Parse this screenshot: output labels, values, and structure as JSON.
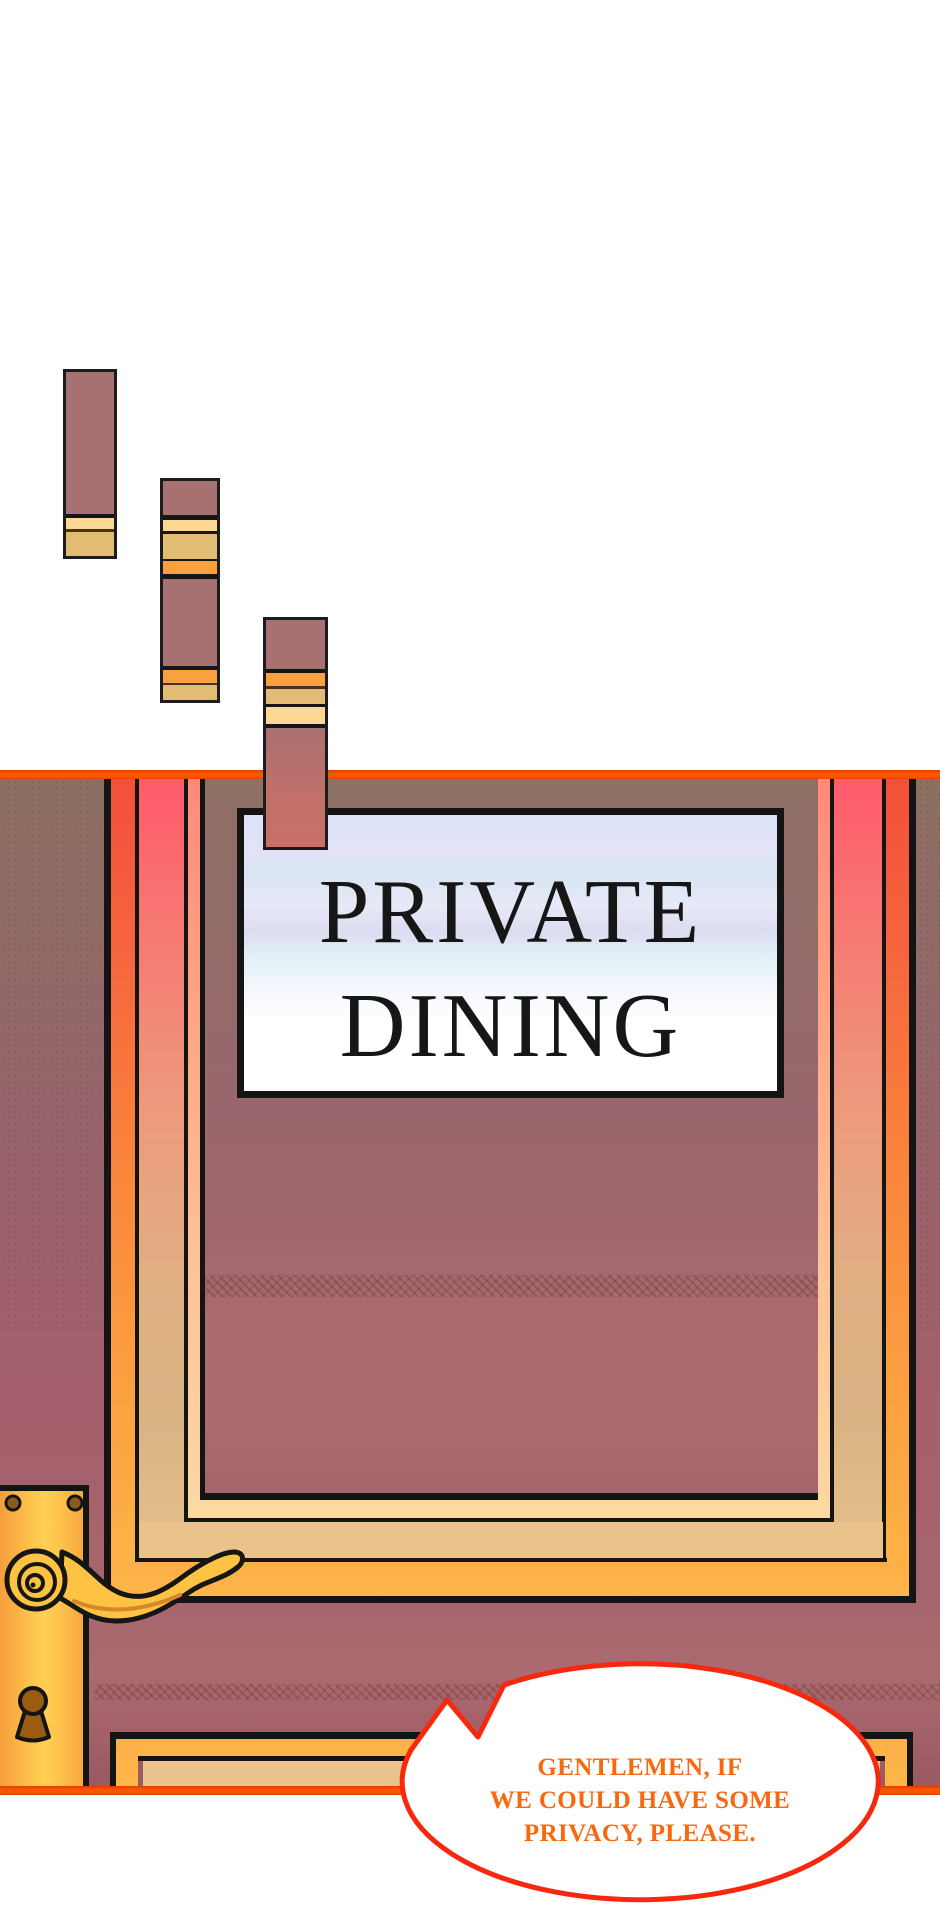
{
  "panel": {
    "type": "webtoon-comic-panel",
    "scene": "restaurant door with private dining sign"
  },
  "sign": {
    "line1": "PRIVATE",
    "line2": "DINING",
    "text_color": "#161616",
    "plate_top_color": "#dde2f8",
    "plate_bottom_color": "#ffffff"
  },
  "speech_bubble": {
    "line1": "GENTLEMEN, IF",
    "line2": "WE COULD HAVE SOME",
    "line3": "PRIVACY, PLEASE.",
    "text_color": "#f8680e",
    "border_color": "#f8280e",
    "fill_color": "#ffffff"
  },
  "colors": {
    "panel_border_orange": "#ff5500",
    "door_wall_top": "#8e7063",
    "door_wall_bottom": "#9a5a63",
    "frame_gold": "#fcab44",
    "frame_tan": "#ddb183",
    "frame_red_top": "#ff5b6b",
    "handle_gold": "#fec343",
    "keyhole_brown": "#9a5c10",
    "plank_maroon": "#a87171",
    "plank_tan": "#e2bc72",
    "plank_cream": "#fdd794",
    "plank_orange": "#f9a03f"
  }
}
